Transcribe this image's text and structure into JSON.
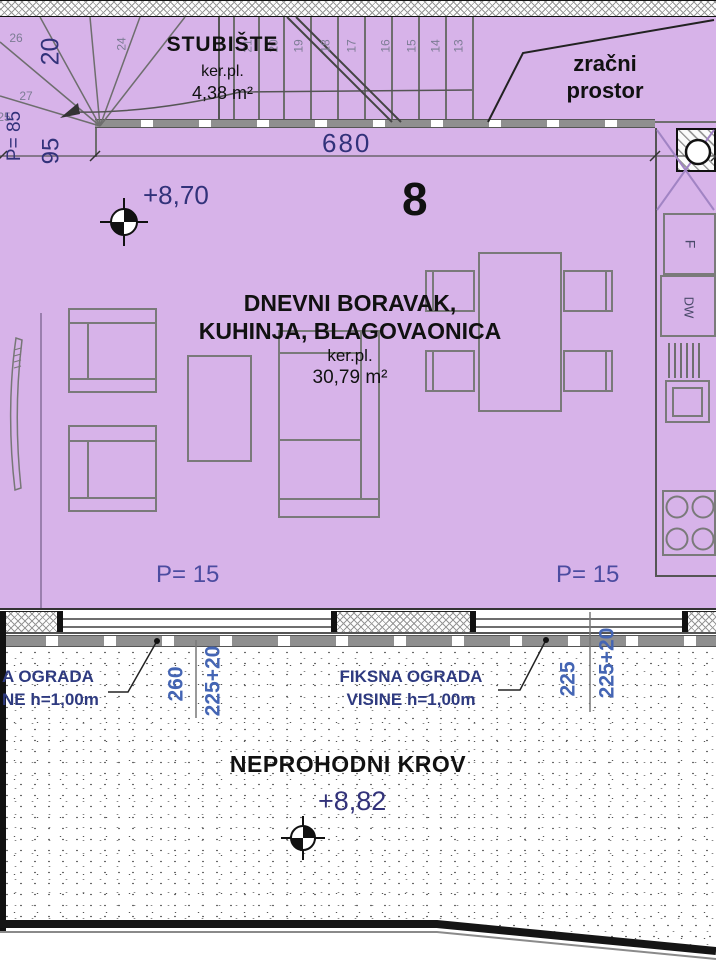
{
  "colors": {
    "room_fill": "#d7b3e9",
    "dim_text": "#32327a",
    "roof_dim_text": "#4465b4",
    "parapet_text": "#4c4ca0",
    "label_text": "#111111"
  },
  "staircase": {
    "title": "STUBIŠTE",
    "material": "ker.pl.",
    "area": "4,38 m²",
    "dim_wall": "20",
    "dim_landing": "95",
    "parapet": "P= 85",
    "steps": [
      "26",
      "27",
      "25",
      "24",
      "21",
      "20",
      "19",
      "18",
      "17",
      "16",
      "15",
      "14",
      "13"
    ]
  },
  "air_space": {
    "line1": "zračni",
    "line2": "prostor"
  },
  "dims": {
    "width_top": "680"
  },
  "living": {
    "number": "8",
    "level": "+8,70",
    "name1": "DNEVNI BORAVAK,",
    "name2": "KUHINJA, BLAGOVAONICA",
    "material": "ker.pl.",
    "area": "30,79 m²",
    "parapet_left": "P= 15",
    "parapet_right": "P= 15"
  },
  "kitchen": {
    "fridge": "F",
    "dishwasher": "DW"
  },
  "balcony": {
    "railing_label1": "FIKSNA OGRADA",
    "railing_label2": "VISINE h=1,00m",
    "railing_left1": "A OGRADA",
    "railing_left2": "NE h=1,00m",
    "dim_260": "260",
    "dim_225_20_left": "225+20",
    "dim_225": "225",
    "dim_225_20_right": "225+20"
  },
  "roof": {
    "label": "NEPROHODNI KROV",
    "level": "+8,82"
  }
}
